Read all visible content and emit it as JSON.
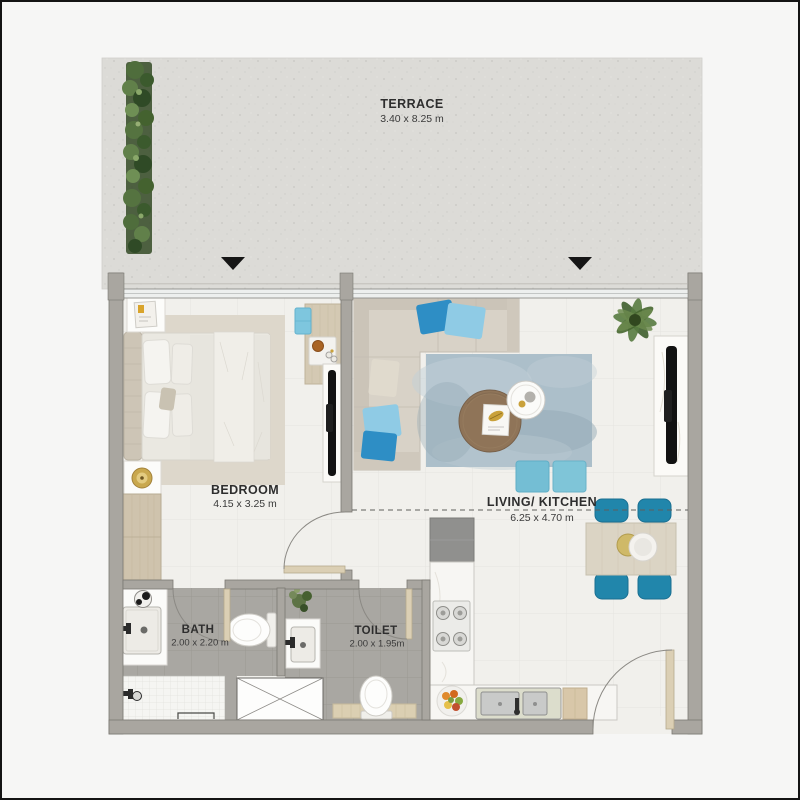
{
  "plan_title": "apartment-floor-plan",
  "rooms": {
    "terrace": {
      "name": "TERRACE",
      "dims": "3.40 x 8.25 m"
    },
    "bedroom": {
      "name": "BEDROOM",
      "dims": "4.15 x 3.25 m"
    },
    "living_kitchen": {
      "name": "LIVING/ KITCHEN",
      "dims": "6.25 x 4.70 m"
    },
    "bath": {
      "name": "BATH",
      "dims": "2.00 x 2.20 m"
    },
    "toilet": {
      "name": "TOILET",
      "dims": "2.00 x 1.95m"
    }
  },
  "icons": {
    "terrace_entry_arrow": "▼ black triangle marking terrace access",
    "door_swing_arc": "quarter-circle door swing",
    "shaft_box": "rectangle with X cross (service shaft)"
  },
  "colors": {
    "wall_gray": "#a9a6a0",
    "floor_white": "#f1f0ec",
    "terrace_concrete": "#dcdbd7",
    "wet_room_tile": "#a9a7a2",
    "accent_teal_chair": "#2186ab",
    "accent_pillow_blue": "#2e8ec5",
    "accent_pillow_light": "#8fcbe5",
    "pouf_teal": "#74bed4",
    "wood_light": "#d4c9b3",
    "rug_blue_gray": "#acbfca",
    "sofa_beige": "#d8d2c7",
    "plant_green": "#4f6d3c"
  }
}
